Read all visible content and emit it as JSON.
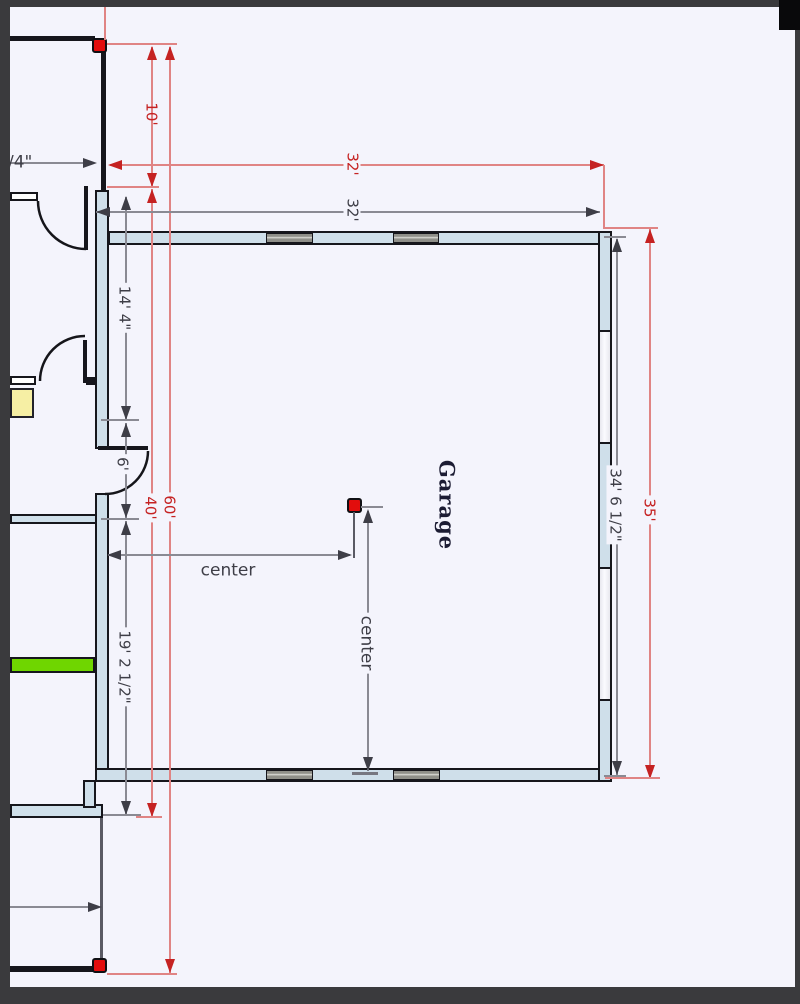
{
  "plan": {
    "room_label": "Garage",
    "labels": {
      "red_offset": "10'",
      "red_width": "32'",
      "gray_width": "32'",
      "red_total_height": "60'",
      "red_garage_height": "40'",
      "red_right_height": "35'",
      "gray_right_height": "34' 6 1/2\"",
      "gray_left_upper": "14' 4\"",
      "gray_left_door": "6'",
      "gray_left_lower": "19' 2 1/2\"",
      "center_horizontal": "center",
      "center_vertical": "center",
      "partial_left": "/4\""
    },
    "colors": {
      "bg": "#f4f4fc",
      "frame": "#3a3a3d",
      "wall_fill": "#cfdfea",
      "wall_stroke": "#16161c",
      "window_gray": "#8f8f89",
      "dim_red": "#c52222",
      "dim_red_line": "#e08484",
      "dim_gray": "#3e3e47",
      "dim_gray_line": "#8a8a93",
      "marker_red": "#e20d0d",
      "highlight_green": "#6fd600",
      "cabinet_yellow": "#f6efa4",
      "room_text": "#1c1c33"
    }
  }
}
